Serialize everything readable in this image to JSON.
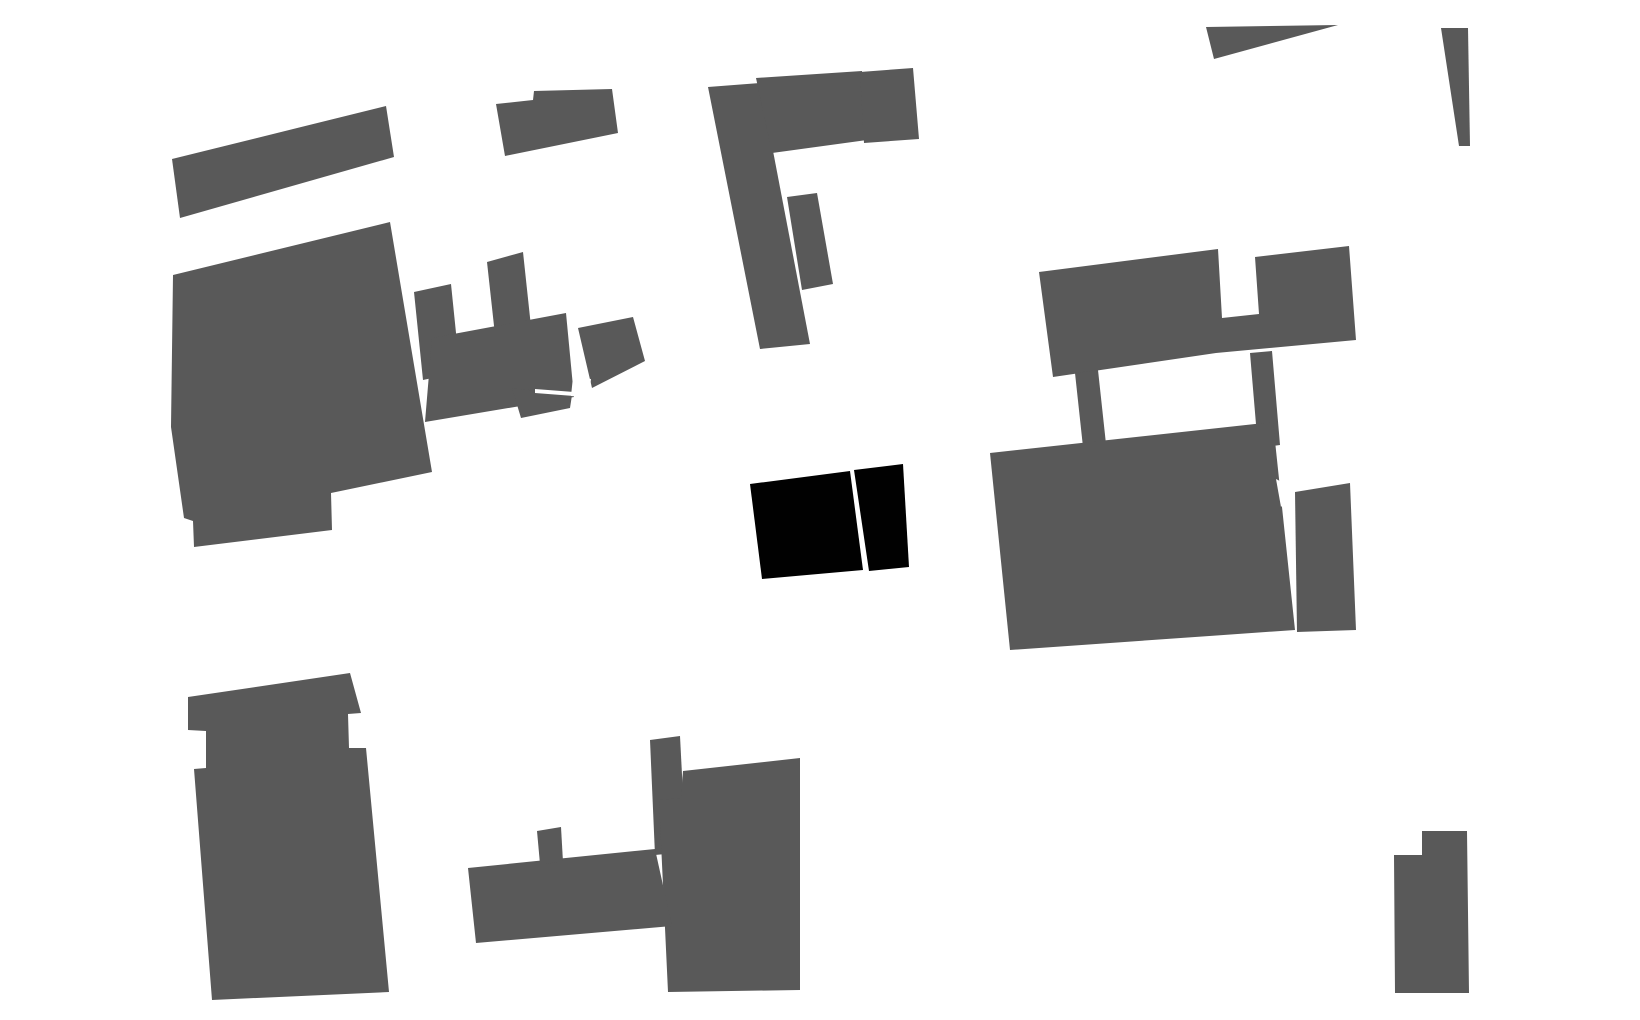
{
  "canvas": {
    "width": 1640,
    "height": 1020,
    "background": "#ffffff"
  },
  "colors": {
    "context_building": "#595959",
    "highlight_building": "#010101",
    "white_gap": "#ffffff"
  },
  "map": {
    "kind": "figure-ground site plan",
    "highlighted_building_count": 2,
    "context_building_count": 25
  },
  "buildings": [
    {
      "name": "strip-northwest",
      "role": "context",
      "points": "172,159 386,106 394,157 180,218"
    },
    {
      "name": "small-block-north",
      "role": "context",
      "points": "496,104 533,100 534,91 612,89 618,133 505,156"
    },
    {
      "name": "large-blob-west",
      "role": "context",
      "points": "173,275 171,427 184,518 193,521 194,547 332,530 331,493 432,472 390,222"
    },
    {
      "name": "cluster-left-stem",
      "role": "context",
      "points": "414,292 451,284 460,372 423,380"
    },
    {
      "name": "cluster-center-stem",
      "role": "context",
      "points": "487,262 523,252 532,336 496,344"
    },
    {
      "name": "cluster-arm",
      "role": "context",
      "points": "432,338 566,313 574,397 425,422"
    },
    {
      "name": "cluster-right-block",
      "role": "context",
      "points": "578,328 633,317 645,361 592,388"
    },
    {
      "name": "cluster-tongue",
      "role": "context",
      "points": "512,388 572,395 570,408 521,418"
    },
    {
      "name": "north-center-stem",
      "role": "context",
      "points": "708,87 760,83 810,344 760,349"
    },
    {
      "name": "north-center-bar",
      "role": "context",
      "points": "756,78 862,71 867,140 772,153"
    },
    {
      "name": "north-center-end",
      "role": "context",
      "points": "860,72 913,68 919,139 864,143"
    },
    {
      "name": "north-center-tab",
      "role": "context",
      "points": "787,197 817,193 833,284 802,290"
    },
    {
      "name": "east-upper-c-shape",
      "role": "context",
      "points": "1039,272 1218,249 1222,318 1259,314 1255,257 1349,246 1356,340 1216,353 1053,377"
    },
    {
      "name": "east-connector-left",
      "role": "context",
      "points": "1075,373 1098,370 1106,444 1083,447"
    },
    {
      "name": "east-connector-right",
      "role": "context",
      "points": "1250,353 1272,351 1280,445 1258,448"
    },
    {
      "name": "east-large-block",
      "role": "context",
      "points": "990,453 1273,422 1295,630 1010,650"
    },
    {
      "name": "east-block-extension",
      "role": "context",
      "points": "1295,492 1350,483 1356,630 1297,632"
    },
    {
      "name": "southwest-tower",
      "role": "context",
      "points": "188,697 350,673 361,713 348,714 349,748 366,748 389,992 212,1000 194,769 206,768 206,731 188,730"
    },
    {
      "name": "south-center-stem",
      "role": "context",
      "points": "650,740 680,736 686,852 655,855"
    },
    {
      "name": "south-center-block",
      "role": "context",
      "points": "683,771 800,758 800,990 668,992 659,800 681,798"
    },
    {
      "name": "south-center-arm",
      "role": "context",
      "points": "468,868 655,849 672,926 476,943"
    },
    {
      "name": "south-center-tab",
      "role": "context",
      "points": "537,831 561,827 563,862 540,864"
    },
    {
      "name": "southeast-block",
      "role": "context",
      "points": "1394,855 1422,855 1422,831 1467,831 1469,993 1395,993"
    },
    {
      "name": "northeast-triangle",
      "role": "context",
      "points": "1206,27 1338,25 1214,59"
    },
    {
      "name": "northeast-wedge",
      "role": "context",
      "points": "1441,28 1468,28 1470,146 1459,146"
    },
    {
      "name": "cluster-slit-gap",
      "role": "gap",
      "points": "535,389 574,392 574,396 535,393"
    },
    {
      "name": "cluster-notch-gap",
      "role": "gap",
      "points": "573,377 591,379 589,398 571,396"
    },
    {
      "name": "east-block-notch-gap",
      "role": "gap",
      "points": "1276,479 1297,490 1281,507"
    },
    {
      "name": "highlight-west-half",
      "role": "highlight",
      "points": "750,484 850,471 863,570 762,579"
    },
    {
      "name": "highlight-east-half",
      "role": "highlight",
      "points": "854,470 903,464 909,567 869,571"
    }
  ]
}
